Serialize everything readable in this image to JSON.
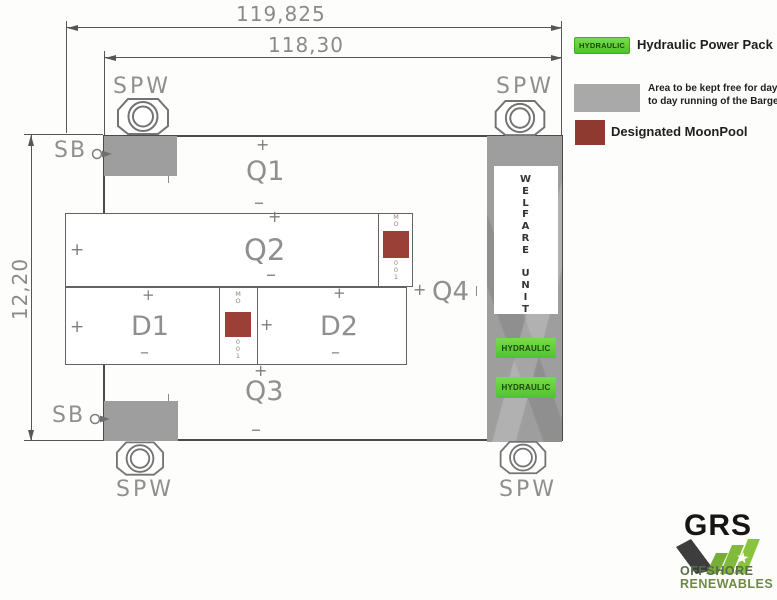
{
  "dimensions": {
    "overall_length": "119,825",
    "deck_length": "118,30",
    "beam_width": "12,20"
  },
  "labels": {
    "spw": "SPW",
    "sb": "SB",
    "q1": "Q1",
    "q2": "Q2",
    "q3": "Q3",
    "q4": "Q4",
    "d1": "D1",
    "d2": "D2",
    "hydraulic": "HYDRAULIC",
    "welfare_unit": "W\nE\nL\nF\nA\nR\nE\n \nU\nN\nI\nT"
  },
  "glyphs": {
    "plus": "+",
    "minus": "–",
    "star": "★"
  },
  "moonpool_tag": {
    "top": "M\nO",
    "bottom": "0\n0\n1"
  },
  "legend": {
    "items": [
      {
        "swatch_text": "HYDRAULIC",
        "label": "Hydraulic Power Pack 1 + 2",
        "color": "#55cf35"
      },
      {
        "label_line1": "Area to be kept free for day",
        "label_line2": "to day running of the Barge",
        "color": "#a9a9a9"
      },
      {
        "label": "Designated MoonPool",
        "color": "#8e3a30"
      }
    ]
  },
  "logo": {
    "name": "GRS",
    "line1": "OFFSHORE",
    "line2": "RENEWABLES"
  },
  "colors": {
    "line": "#565656",
    "cad_text": "#8f8f8f",
    "keep_free_gray": "#9e9e9e",
    "moonpool_red": "#9a4036",
    "hydraulic_green": "#55cf35",
    "logo_green": "#82ba3e",
    "logo_dark": "#3d3d3d"
  }
}
